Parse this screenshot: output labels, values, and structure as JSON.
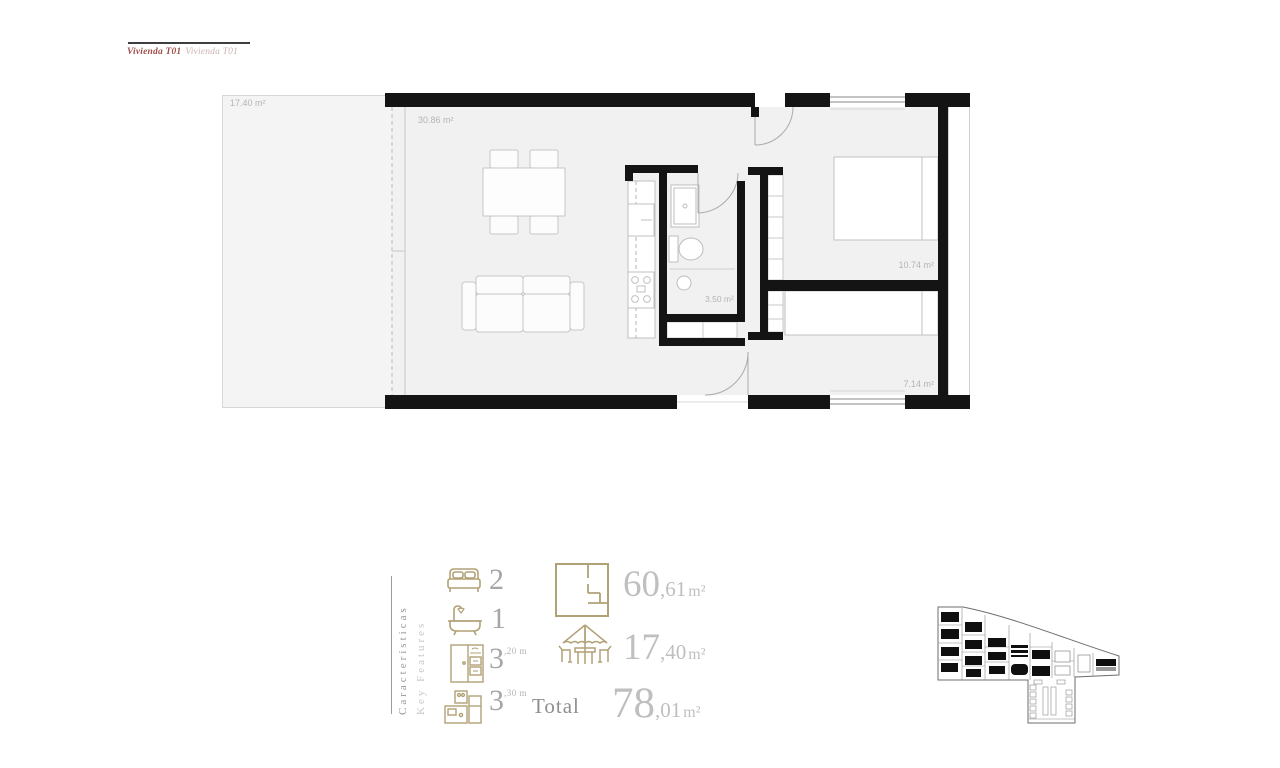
{
  "header": {
    "title_primary": "Vivienda T01",
    "title_secondary": "Vivienda T01"
  },
  "floor_plan": {
    "terrace_label": "17.40 m²",
    "living_label": "30.86 m²",
    "bathroom_label": "3.50 m²",
    "bedroom1_label": "10.74 m²",
    "bedroom2_label": "7.14 m²"
  },
  "features": {
    "heading_es": "Características",
    "heading_en": "Key Features",
    "items": [
      {
        "icon": "bed-icon",
        "count": "2",
        "sup": ""
      },
      {
        "icon": "bathtub-icon",
        "count": "1",
        "sup": ""
      },
      {
        "icon": "wardrobe-icon",
        "count": "3",
        "sup": ",20 m"
      },
      {
        "icon": "kitchen-icon",
        "count": "3",
        "sup": ",30 m"
      }
    ],
    "areas": [
      {
        "icon": "floorplan-icon",
        "value_main": "60",
        "value_dec": ",61",
        "unit": "m²"
      },
      {
        "icon": "parasol-icon",
        "value_main": "17",
        "value_dec": ",40",
        "unit": "m²"
      }
    ],
    "total": {
      "label": "Total",
      "value_main": "78",
      "value_dec": ",01",
      "unit": "m²"
    }
  },
  "colors": {
    "accent_khaki": "#b1a176",
    "number_gray": "#bfbfbf",
    "title_maroon": "#9e4f4a",
    "wall_black": "#141414"
  }
}
